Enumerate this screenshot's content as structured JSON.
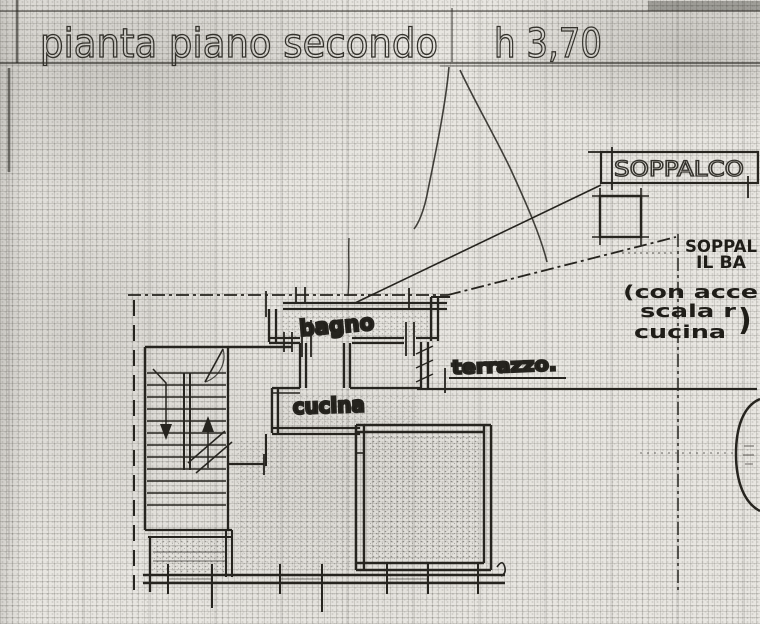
{
  "title": {
    "text": "pianta piano secondo",
    "height_note": "h 3,70"
  },
  "plan_labels": {
    "soppalco": "SOPPALCO",
    "bagno": "bagno",
    "cucina": "cucina",
    "terrazzo": "terrazzo."
  },
  "margin_note": {
    "lines": [
      "SOPPAL",
      "IL BA",
      "(con acce",
      "scala r",
      "cucina"
    ],
    "closing_paren": ")"
  },
  "colors": {
    "paper": "#e8e6e1",
    "ink": "#26241f",
    "grid": "#7d7c74"
  }
}
